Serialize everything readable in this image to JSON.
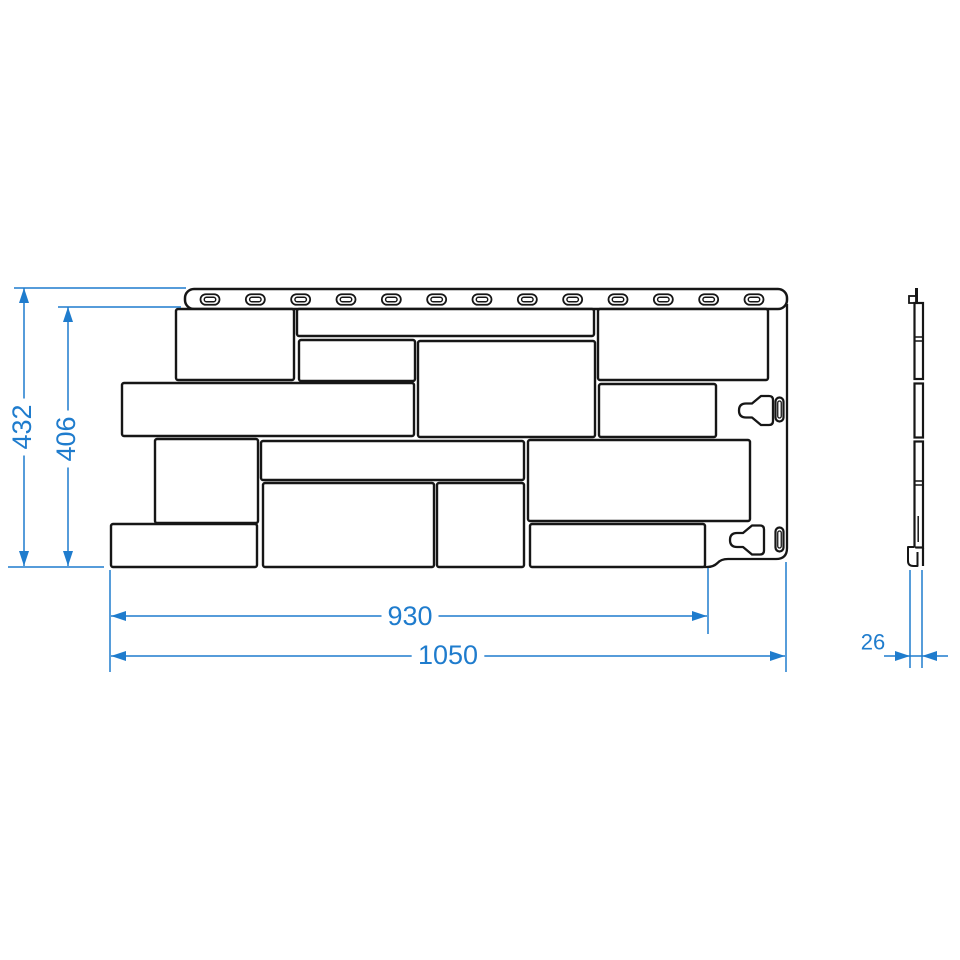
{
  "drawing": {
    "description": "Facade panel technical drawing: front view with stone blocks, nail strip and mounting hooks, side profile view, and linear dimensions",
    "colors": {
      "line": "#161616",
      "dimension": "#1f7ccd",
      "background": "#ffffff"
    },
    "front_view": {
      "top_strip": {
        "x": 185,
        "y": 289,
        "w": 602,
        "h": 20,
        "r": 9
      },
      "nail_slots": {
        "count": 13,
        "first_cx": 210,
        "last_cx": 754,
        "cy": 299.5,
        "outer_w": 19,
        "outer_h": 10.5,
        "inner_w": 11.5,
        "inner_h": 4.5
      },
      "right_flange_path": "M787 304 L787 548 Q787 559 776 559 L728 559 Q721 559 717.5 563 Q713.5 567 707 567 L704 567",
      "stones": [
        {
          "x": 176,
          "y": 309,
          "w": 118,
          "h": 71
        },
        {
          "x": 297,
          "y": 309,
          "w": 297,
          "h": 27
        },
        {
          "x": 299,
          "y": 340,
          "w": 116,
          "h": 41
        },
        {
          "x": 418,
          "y": 341,
          "w": 177,
          "h": 96
        },
        {
          "x": 598,
          "y": 309,
          "w": 170,
          "h": 71
        },
        {
          "x": 599,
          "y": 384,
          "w": 117,
          "h": 53
        },
        {
          "x": 122,
          "y": 383,
          "w": 292,
          "h": 53
        },
        {
          "x": 155,
          "y": 439,
          "w": 103,
          "h": 84
        },
        {
          "x": 261,
          "y": 441,
          "w": 263,
          "h": 39
        },
        {
          "x": 528,
          "y": 440,
          "w": 222,
          "h": 81
        },
        {
          "x": 263,
          "y": 483,
          "w": 171,
          "h": 84
        },
        {
          "x": 437,
          "y": 483,
          "w": 87,
          "h": 84
        },
        {
          "x": 111,
          "y": 524,
          "w": 146,
          "h": 43
        },
        {
          "x": 530,
          "y": 524,
          "w": 175,
          "h": 43
        }
      ],
      "hooks": [
        {
          "funnel_right": 773,
          "cy": 410.5,
          "slot_cx": 779.5,
          "slot_cy": 409.5
        },
        {
          "funnel_right": 764,
          "cy": 540,
          "slot_cx": 779.5,
          "slot_cy": 539.5
        }
      ]
    },
    "side_view": {
      "shapes": [
        {
          "t": "line",
          "x1": 916.5,
          "y1": 288,
          "x2": 916.5,
          "y2": 303,
          "sw": 3
        },
        {
          "t": "rect",
          "x": 909,
          "y": 296,
          "w": 7,
          "h": 7,
          "sw": 1.8
        },
        {
          "t": "rect",
          "x": 914.5,
          "y": 303,
          "w": 8.5,
          "h": 76,
          "sw": 2.2
        },
        {
          "t": "line",
          "x1": 914.5,
          "y1": 337,
          "x2": 923,
          "y2": 337,
          "sw": 1.5
        },
        {
          "t": "line",
          "x1": 914.5,
          "y1": 341,
          "x2": 923,
          "y2": 341,
          "sw": 1.5
        },
        {
          "t": "rect",
          "x": 914.5,
          "y": 383.5,
          "w": 8.5,
          "h": 54,
          "sw": 2.2
        },
        {
          "t": "rect",
          "x": 914.5,
          "y": 441.5,
          "w": 8.5,
          "h": 106,
          "sw": 2.2
        },
        {
          "t": "line",
          "x1": 914.5,
          "y1": 481,
          "x2": 923,
          "y2": 481,
          "sw": 1.5
        },
        {
          "t": "line",
          "x1": 914.5,
          "y1": 485,
          "x2": 923,
          "y2": 485,
          "sw": 1.5
        },
        {
          "t": "line",
          "x1": 918.2,
          "y1": 516,
          "x2": 918.2,
          "y2": 542,
          "sw": 1.5
        },
        {
          "t": "path",
          "d": "M914.5 547 L908 547 L908 561 Q908 566 913.5 566 L917.5 566 L917.5 552",
          "sw": 2
        },
        {
          "t": "line",
          "x1": 923,
          "y1": 548,
          "x2": 923,
          "y2": 566,
          "sw": 2.2
        }
      ]
    },
    "dims": [
      {
        "id": "overall-height",
        "label": "432",
        "orient": "v",
        "x": 24,
        "y1": 288,
        "y2": 566,
        "tx": 22,
        "ty": 427,
        "fs": 27
      },
      {
        "id": "field-height",
        "label": "406",
        "orient": "v",
        "x": 68,
        "y1": 307,
        "y2": 566,
        "tx": 66,
        "ty": 439,
        "fs": 27
      },
      {
        "id": "field-width",
        "label": "930",
        "orient": "h",
        "y": 616,
        "x1": 111,
        "x2": 707,
        "tx": 410,
        "ty": 616,
        "fs": 27
      },
      {
        "id": "overall-width",
        "label": "1050",
        "orient": "h",
        "y": 656,
        "x1": 111,
        "x2": 785,
        "tx": 448,
        "ty": 655,
        "fs": 27
      },
      {
        "id": "panel-thickness",
        "label": "26",
        "orient": "h-out",
        "y": 656,
        "x1": 910,
        "x2": 922,
        "tail": 26,
        "tx": 873,
        "ty": 642,
        "fs": 22
      }
    ],
    "extension_lines": [
      {
        "x1": 14,
        "y1": 288,
        "x2": 186,
        "y2": 288
      },
      {
        "x1": 58,
        "y1": 307,
        "x2": 181,
        "y2": 307
      },
      {
        "x1": 8,
        "y1": 567,
        "x2": 104,
        "y2": 567
      },
      {
        "x1": 110,
        "y1": 570,
        "x2": 110,
        "y2": 672
      },
      {
        "x1": 708,
        "y1": 568,
        "x2": 708,
        "y2": 634
      },
      {
        "x1": 786,
        "y1": 562,
        "x2": 786,
        "y2": 672
      },
      {
        "x1": 910,
        "y1": 570,
        "x2": 910,
        "y2": 668
      },
      {
        "x1": 922,
        "y1": 570,
        "x2": 922,
        "y2": 668
      }
    ]
  }
}
